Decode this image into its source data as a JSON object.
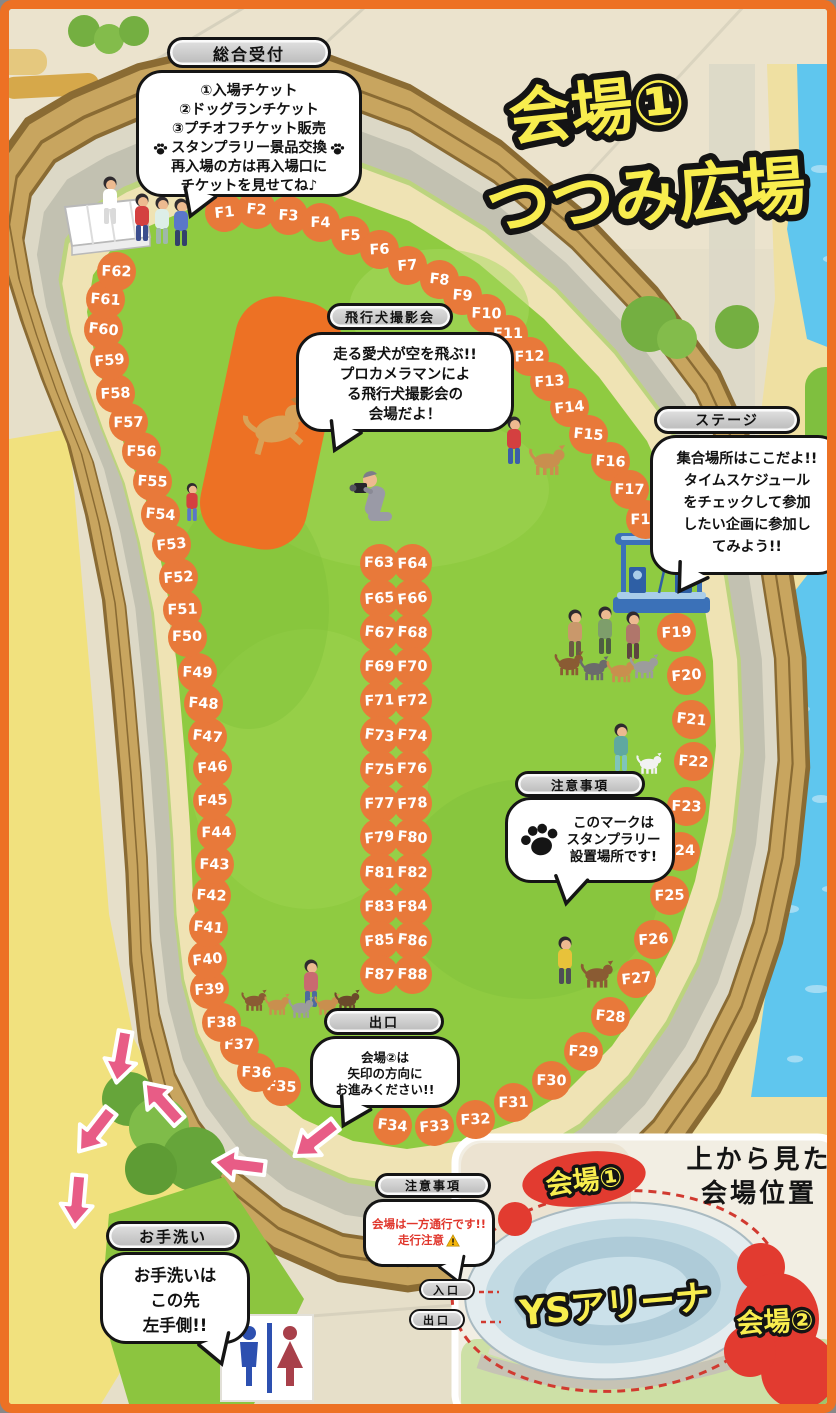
{
  "title": {
    "line1": "会場①",
    "line2": "つつみ広場"
  },
  "reception": {
    "label": "総合受付",
    "line1": "①入場チケット",
    "line2": "②ドッグランチケット",
    "line3": "③プチオフチケット販売",
    "line4": "スタンプラリー景品交換",
    "line5": "再入場の方は再入場口に",
    "line6": "チケットを見せてね♪"
  },
  "flying_dog": {
    "label": "飛行犬撮影会",
    "line1": "走る愛犬が空を飛ぶ!!",
    "line2": "プロカメラマンによ",
    "line3": "る飛行犬撮影会の",
    "line4": "会場だよ！"
  },
  "stage": {
    "label": "ステージ",
    "line1": "集合場所はここだよ!!",
    "line2": "タイムスケジュール",
    "line3": "をチェックして参加",
    "line4": "したい企画に参加し",
    "line5": "てみよう!!"
  },
  "stamp_rally": {
    "label": "注意事項",
    "line1": "このマークは",
    "line2": "スタンプラリー",
    "line3": "設置場所です!"
  },
  "exit_info": {
    "label": "出口",
    "line1": "会場②は",
    "line2": "矢印の方向に",
    "line3": "お進みください!!"
  },
  "restroom": {
    "label": "お手洗い",
    "line1": "お手洗いは",
    "line2": "この先",
    "line3": "左手側!!"
  },
  "one_way": {
    "label": "注意事項",
    "line1": "会場は一方通行です!!",
    "line2": "走行注意"
  },
  "inset": {
    "heading_line1": "上から見た",
    "heading_line2": "会場位置",
    "venue1_label": "会場①",
    "venue2_label": "会場②",
    "arena_label": "YSアリーナ",
    "entrance_label": "入口",
    "exit_label": "出口"
  },
  "booths": [
    "F1",
    "F2",
    "F3",
    "F4",
    "F5",
    "F6",
    "F7",
    "F8",
    "F9",
    "F10",
    "F11",
    "F12",
    "F13",
    "F14",
    "F15",
    "F16",
    "F17",
    "F18",
    "F19",
    "F20",
    "F21",
    "F22",
    "F23",
    "F24",
    "F25",
    "F26",
    "F27",
    "F28",
    "F29",
    "F30",
    "F31",
    "F32",
    "F33",
    "F34",
    "F35",
    "F36",
    "F37",
    "F38",
    "F39",
    "F40",
    "F41",
    "F42",
    "F43",
    "F44",
    "F45",
    "F46",
    "F47",
    "F48",
    "F49",
    "F50",
    "F51",
    "F52",
    "F53",
    "F54",
    "F55",
    "F56",
    "F57",
    "F58",
    "F59",
    "F60",
    "F61",
    "F62",
    "F63",
    "F64",
    "F65",
    "F66",
    "F67",
    "F68",
    "F69",
    "F70",
    "F71",
    "F72",
    "F73",
    "F74",
    "F75",
    "F76",
    "F77",
    "F78",
    "F79",
    "F80",
    "F81",
    "F82",
    "F83",
    "F84",
    "F85",
    "F86",
    "F87",
    "F88"
  ],
  "colors": {
    "frame_orange": "#ED7124",
    "booth_orange": "#E8793A",
    "title_yellow": "#F8ED4E",
    "arrow_pink": "#E85C86",
    "venue_red": "#E23B30",
    "caution_red": "#E0362C"
  }
}
